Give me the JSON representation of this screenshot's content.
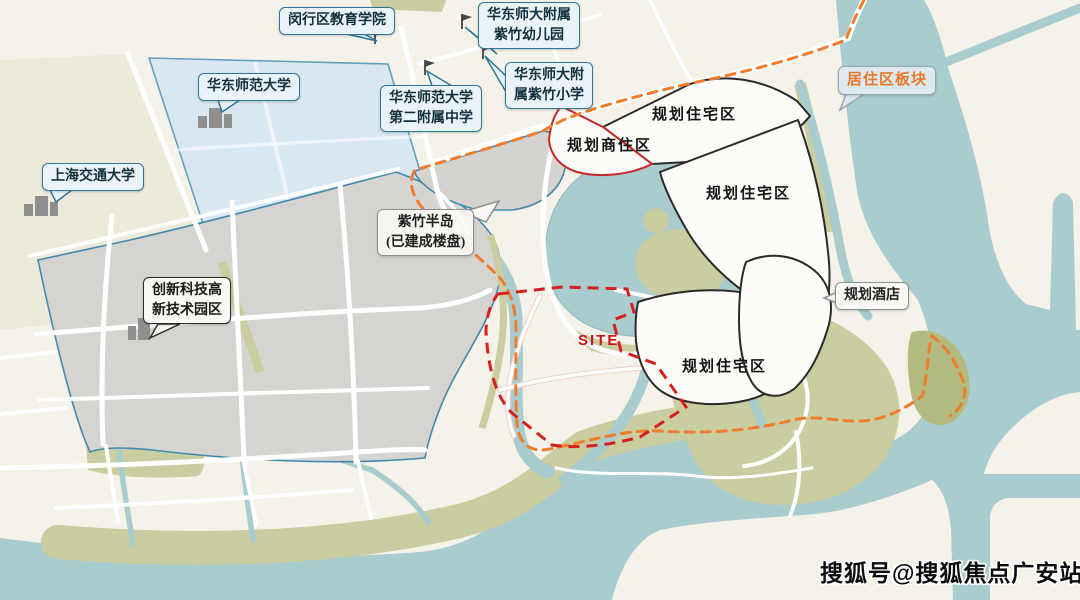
{
  "map": {
    "callouts": {
      "minhang_edu_college": "闵行区教育学院",
      "ecnu_kindergarten": "华东师大附属\n紫竹幼儿园",
      "ecnu_no2_high_school": "华东师范大学\n第二附属中学",
      "ecnu_zizhu_primary": "华东师大附\n属紫竹小学",
      "ecnu": "华东师范大学",
      "sjtu": "上海交通大学",
      "innovation_tech_park": "创新科技高\n新技术园区",
      "zizhu_peninsula": "紫竹半岛\n(已建成楼盘)",
      "residential_block": "居住区板块",
      "planned_hotel": "规划酒店"
    },
    "zones": {
      "planned_commercial_residential": "规划商住区",
      "planned_residential_1": "规划住宅区",
      "planned_residential_2": "规划住宅区",
      "planned_residential_3": "规划住宅区",
      "site": "SITE"
    },
    "watermark": "搜狐号@搜狐焦点广安站",
    "icons": {
      "school_flag": "flag",
      "campus_building": "building"
    },
    "colors": {
      "water": "#a9cccf",
      "land_cream": "#f5f2e9",
      "campus_blue": "#d9e7f1",
      "built_gray": "#d6d4d0",
      "greenery": "#c9cda0",
      "boundary_orange": "#ef7d2e",
      "site_red": "#d61f1f",
      "outline_black": "#2b2b2b",
      "callout_blue": "#2f7796",
      "label_orange": "#e8792a"
    }
  }
}
